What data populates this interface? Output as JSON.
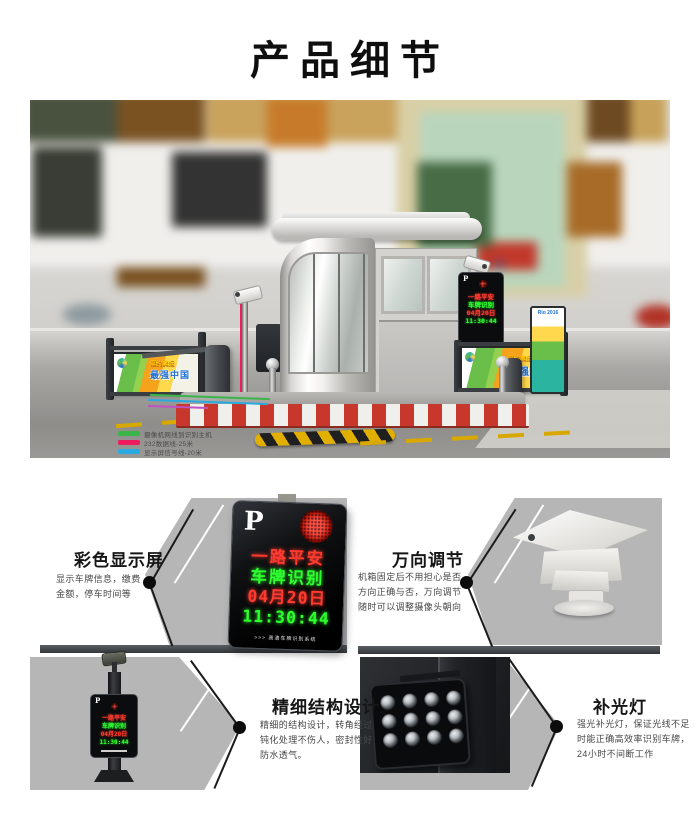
{
  "page": {
    "title": "产品细节"
  },
  "hero": {
    "legend": {
      "items": [
        {
          "label": "摄像机网线到识别主机",
          "color": "#3ab54a"
        },
        {
          "label": "232数据线-25米",
          "color": "#ed1c5c"
        },
        {
          "label": "显示屏信号线-20米",
          "color": "#29abe2"
        },
        {
          "label": "开关供电线-4芯线",
          "color": "#5f52a0"
        },
        {
          "label": "摄像机485控制线-2芯线",
          "color": "#c052c0"
        }
      ]
    },
    "banner": {
      "line1": "里约奥运",
      "line2": "最强中国"
    },
    "ticket_brand": "Rio 2016"
  },
  "led_display": {
    "logo": "P",
    "footer": ">>> 高清车牌识别系统",
    "lines": [
      {
        "text": "一路平安",
        "color": "#ff3b30"
      },
      {
        "text": "车牌识别",
        "color": "#2eff2e"
      },
      {
        "text": "04月20日",
        "color": "#ff3b30"
      },
      {
        "text": "11:30:44",
        "color": "#2eff2e"
      }
    ]
  },
  "features": [
    {
      "title": "彩色显示屏",
      "desc": "显示车牌信息，缴费金额，停车时间等"
    },
    {
      "title": "万向调节",
      "desc": "机箱固定后不用担心是否方向正确与否，万向调节随时可以调整摄像头朝向"
    },
    {
      "title": "精细结构设计",
      "desc": "精细的结构设计，转角经过钝化处理不伤人，密封性好防水透气。"
    },
    {
      "title": "补光灯",
      "desc": "强光补光灯，保证光线不足时能正确高效率识别车牌，24小时不间断工作"
    }
  ]
}
